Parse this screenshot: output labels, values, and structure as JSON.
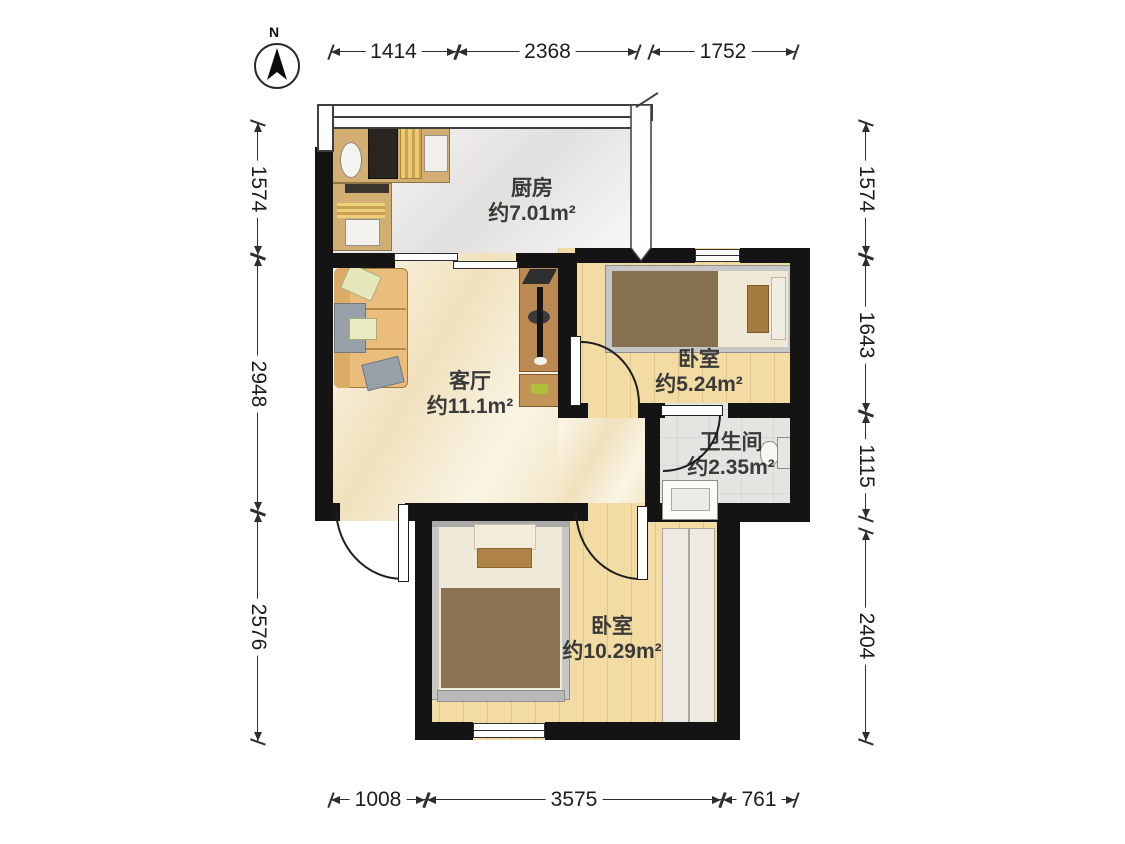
{
  "compass": {
    "label": "N"
  },
  "rooms": [
    {
      "id": "kitchen",
      "name": "厨房",
      "area": "约7.01m²"
    },
    {
      "id": "living-room",
      "name": "客厅",
      "area": "约11.1m²"
    },
    {
      "id": "bedroom-top",
      "name": "卧室",
      "area": "约5.24m²"
    },
    {
      "id": "bathroom",
      "name": "卫生间",
      "area": "约2.35m²"
    },
    {
      "id": "bedroom-bottom",
      "name": "卧室",
      "area": "约10.29m²"
    }
  ],
  "dims": {
    "top": [
      "1414",
      "2368",
      "1752"
    ],
    "bottom": [
      "1008",
      "3575",
      "761"
    ],
    "left": [
      "1574",
      "2948",
      "2576"
    ],
    "right": [
      "1574",
      "1643",
      "1115",
      "2404"
    ]
  },
  "colors": {
    "wall": "#141414",
    "wood_floor": "#f2dca4",
    "marble_floor": "#f6ecd1",
    "tile_floor": "#e9e8e5",
    "counter": "#d3ae72",
    "sofa": "#eabd7d",
    "blanket": "#857050",
    "tv_cabinet": "#ba8a52",
    "label_text": "#3a3a3a"
  }
}
